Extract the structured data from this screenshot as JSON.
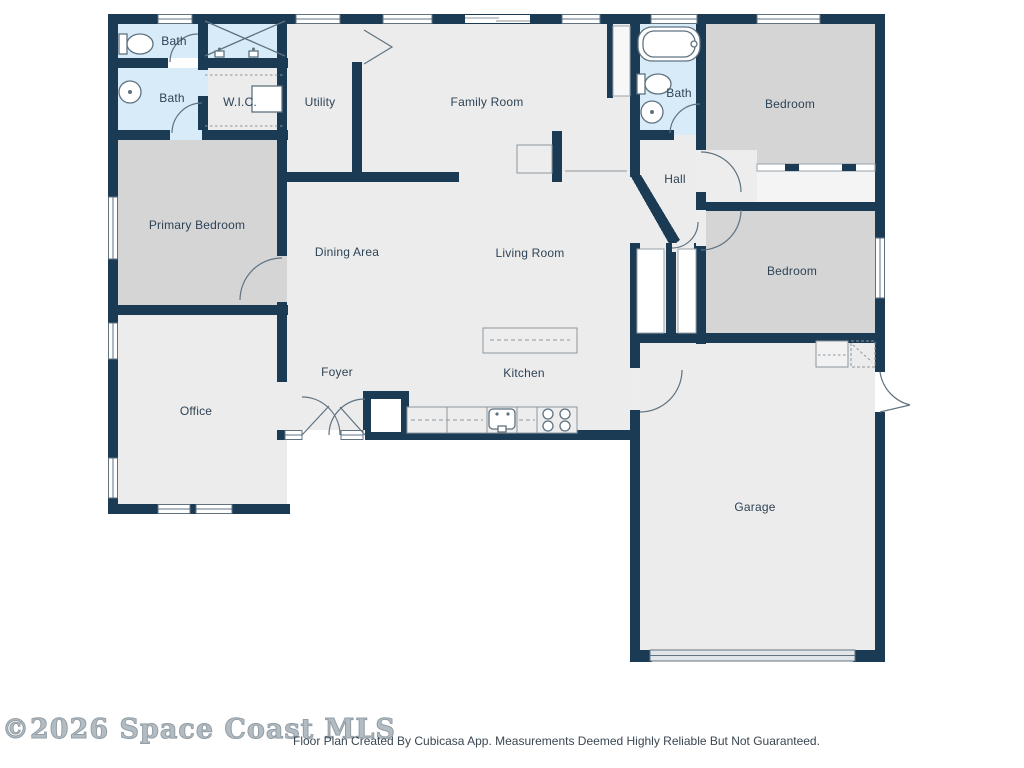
{
  "rooms": [
    {
      "id": "bath-top-left",
      "label": "Bath"
    },
    {
      "id": "bath-left",
      "label": "Bath"
    },
    {
      "id": "walk-in-closet",
      "label": "W.I.C."
    },
    {
      "id": "utility",
      "label": "Utility"
    },
    {
      "id": "family-room",
      "label": "Family Room"
    },
    {
      "id": "bath-right",
      "label": "Bath"
    },
    {
      "id": "bedroom-top-right",
      "label": "Bedroom"
    },
    {
      "id": "hall",
      "label": "Hall"
    },
    {
      "id": "primary-bedroom",
      "label": "Primary Bedroom"
    },
    {
      "id": "dining-area",
      "label": "Dining Area"
    },
    {
      "id": "living-room",
      "label": "Living Room"
    },
    {
      "id": "bedroom-right",
      "label": "Bedroom"
    },
    {
      "id": "office",
      "label": "Office"
    },
    {
      "id": "foyer",
      "label": "Foyer"
    },
    {
      "id": "kitchen",
      "label": "Kitchen"
    },
    {
      "id": "garage",
      "label": "Garage"
    }
  ],
  "footer": {
    "watermark": "©2026 Space Coast MLS",
    "disclaimer": "Floor Plan Created By Cubicasa App. Measurements Deemed Highly Reliable But Not Guaranteed."
  },
  "colors": {
    "wall": "#1b3a54",
    "room_fill": "#ececec",
    "bedroom_fill": "#d5d5d6",
    "bath_fill": "#d7ecf8",
    "fixture_outline": "#5f7280",
    "closet_outline": "#97a2aa",
    "label_text": "#2e4356",
    "watermark_text": "#b3bcc2",
    "disclaimer_text": "#3a4650",
    "garage_door": "#dfe5e9"
  },
  "icons": [
    "toilet-icon",
    "bathtub-icon",
    "round-sink-icon",
    "shower-x-icon",
    "vanity-faucet-icon",
    "stove-icon",
    "kitchen-sink-icon",
    "kitchen-island",
    "closet-shelf-dashes",
    "water-heater-box",
    "door-swing-arc",
    "window-symbol",
    "sliding-door-symbol",
    "garage-door-symbol"
  ]
}
